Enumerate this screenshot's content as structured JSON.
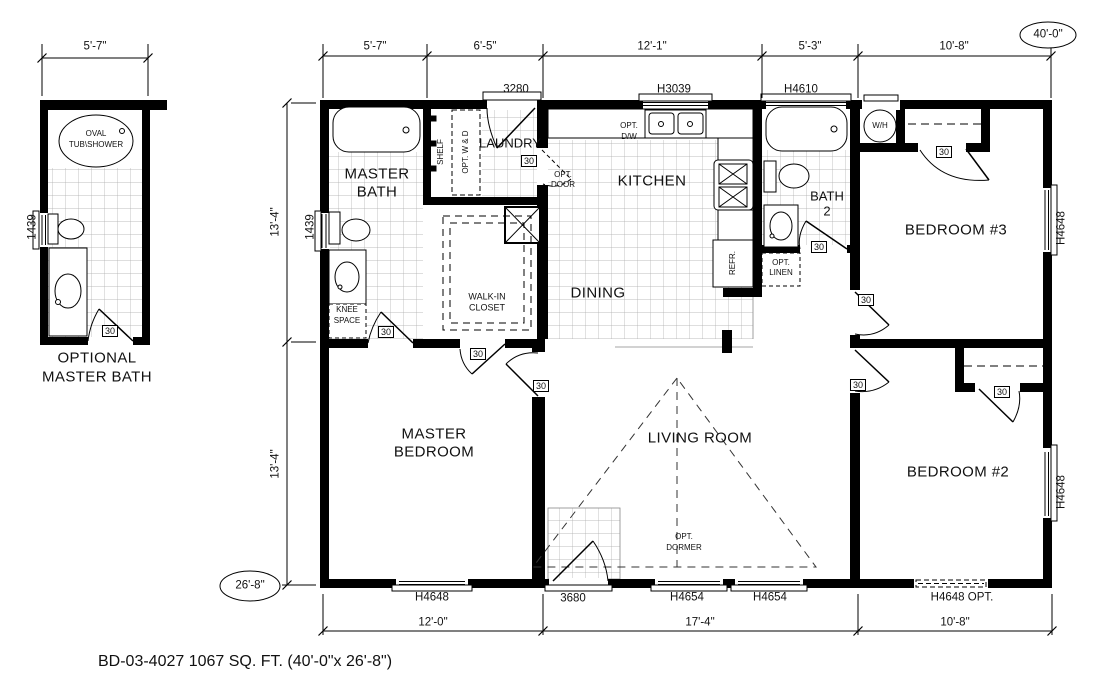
{
  "caption": "BD-03-4027 1067 SQ. FT. (40'-0\"x 26'-8\")",
  "bubbles": {
    "overall_width": "40'-0\"",
    "overall_depth": "26'-8\""
  },
  "dims": {
    "opt_bath_top": "5'-7\"",
    "top": [
      "5'-7\"",
      "6'-5\"",
      "12'-1\"",
      "5'-3\"",
      "10'-8\""
    ],
    "left": [
      "13'-4\"",
      "13'-4\""
    ],
    "bottom": [
      "12'-0\"",
      "17'-4\"",
      "10'-8\""
    ]
  },
  "optional_bath": {
    "title1": "OPTIONAL",
    "title2": "MASTER BATH",
    "tub1": "OVAL",
    "tub2": "TUB\\SHOWER",
    "window": "1439"
  },
  "rooms": {
    "master_bath1": "MASTER",
    "master_bath2": "BATH",
    "laundry": "LAUNDRY",
    "kitchen": "KITCHEN",
    "dining": "DINING",
    "living": "LIVING ROOM",
    "master_bed1": "MASTER",
    "master_bed2": "BEDROOM",
    "bedroom2": "BEDROOM #2",
    "bedroom3": "BEDROOM #3",
    "bath2_1": "BATH",
    "bath2_2": "2",
    "closet1": "WALK-IN",
    "closet2": "CLOSET"
  },
  "fixtures": {
    "shelf": "SHELF",
    "opt_wd": "OPT. W & D",
    "opt_door1": "OPT.",
    "opt_door2": "DOOR",
    "opt_dw1": "OPT.",
    "opt_dw2": "D/W",
    "knee1": "KNEE",
    "knee2": "SPACE",
    "refr": "REFR.",
    "opt_linen1": "OPT.",
    "opt_linen2": "LINEN",
    "opt_dormer1": "OPT.",
    "opt_dormer2": "DORMER",
    "water_heater": "W/H"
  },
  "openings": {
    "door30": "30",
    "door3280": "3280",
    "door3680": "3680",
    "win1439": "1439",
    "winH3039": "H3039",
    "winH4610": "H4610",
    "winH4648": "H4648",
    "winH4648opt": "H4648 OPT.",
    "winH4654": "H4654"
  }
}
